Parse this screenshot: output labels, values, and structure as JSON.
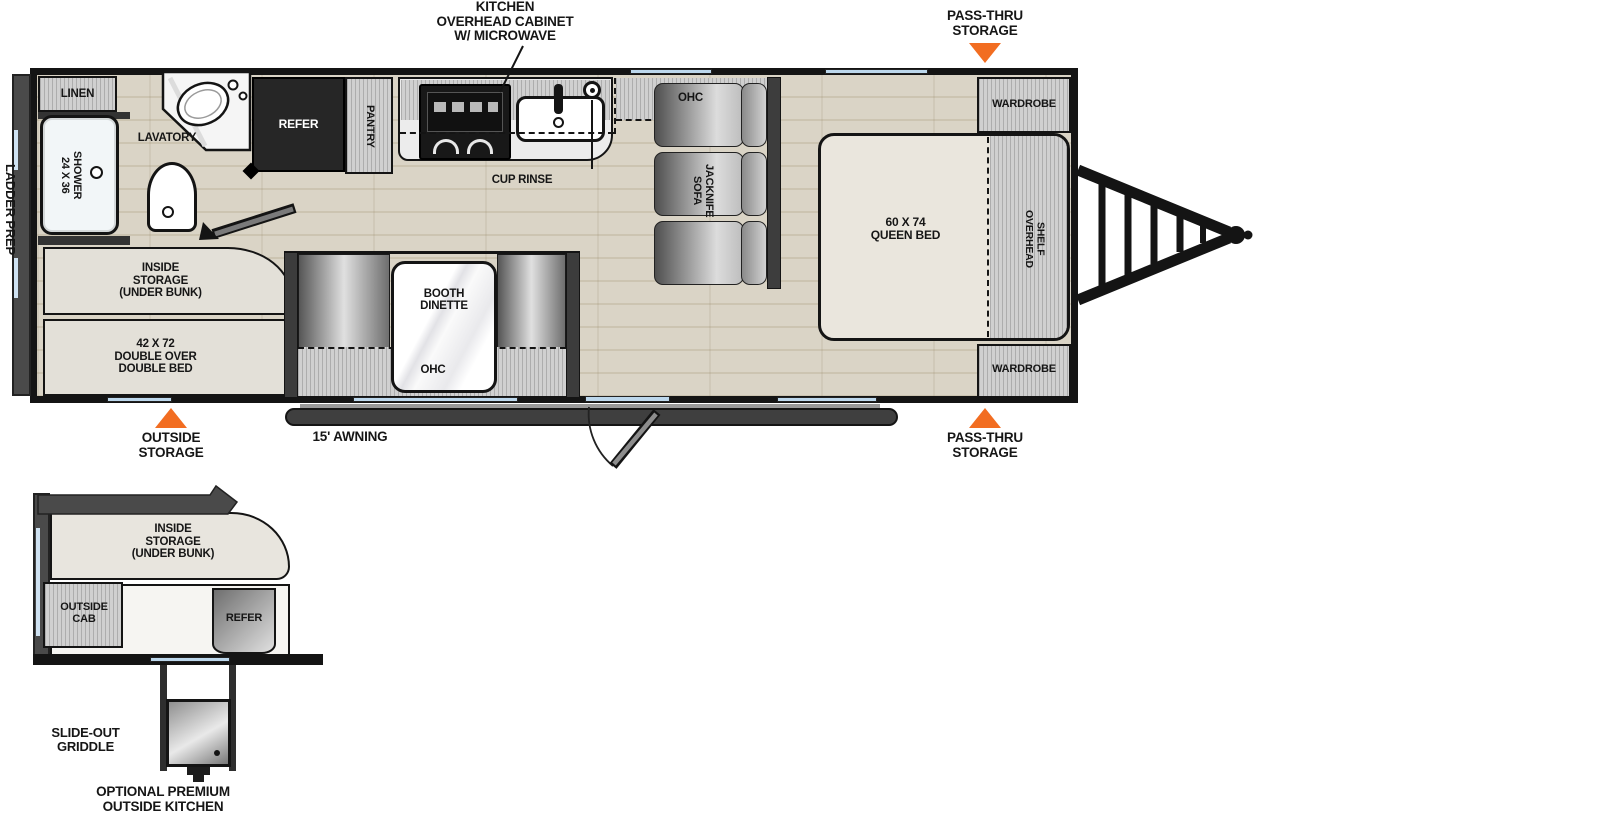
{
  "colors": {
    "wall_black": "#141414",
    "accent_orange": "#f26d21",
    "window_blue": "#bcd7ec",
    "floor_tan": "#d8d2c4",
    "cabinet_gray": "#c9c9c9",
    "appliance_dark": "#262626"
  },
  "callouts": {
    "kitchen_overhead": "KITCHEN\nOVERHEAD CABINET\nW/ MICROWAVE",
    "pass_thru_top": "PASS-THRU\nSTORAGE",
    "pass_thru_bottom": "PASS-THRU\nSTORAGE",
    "outside_storage": "OUTSIDE\nSTORAGE",
    "awning": "15' AWNING",
    "ladder_prep": "LADDER PREP"
  },
  "main": {
    "linen": "LINEN",
    "lavatory": "LAVATORY",
    "shower": "24 X 36\nSHOWER",
    "refer": "REFER",
    "pantry": "PANTRY",
    "cup_rinse": "CUP RINSE",
    "ohc_kitchen": "OHC",
    "jacknife_sofa": "JACKNIFE\nSOFA",
    "wardrobe_top": "WARDROBE",
    "wardrobe_bottom": "WARDROBE",
    "queen_bed": "60 X 74\nQUEEN BED",
    "overhead_shelf": "OVERHEAD\nSHELF",
    "inside_storage": "INSIDE\nSTORAGE\n(UNDER BUNK)",
    "double_bed": "42 X 72\nDOUBLE OVER\nDOUBLE BED",
    "booth_dinette": "BOOTH\nDINETTE",
    "ohc_dinette": "OHC"
  },
  "detail": {
    "inside_storage": "INSIDE\nSTORAGE\n(UNDER BUNK)",
    "outside_cab": "OUTSIDE\nCAB",
    "refer": "REFER",
    "slide_out_griddle": "SLIDE-OUT\nGRIDDLE",
    "optional_outside_kitchen": "OPTIONAL PREMIUM\nOUTSIDE KITCHEN"
  }
}
